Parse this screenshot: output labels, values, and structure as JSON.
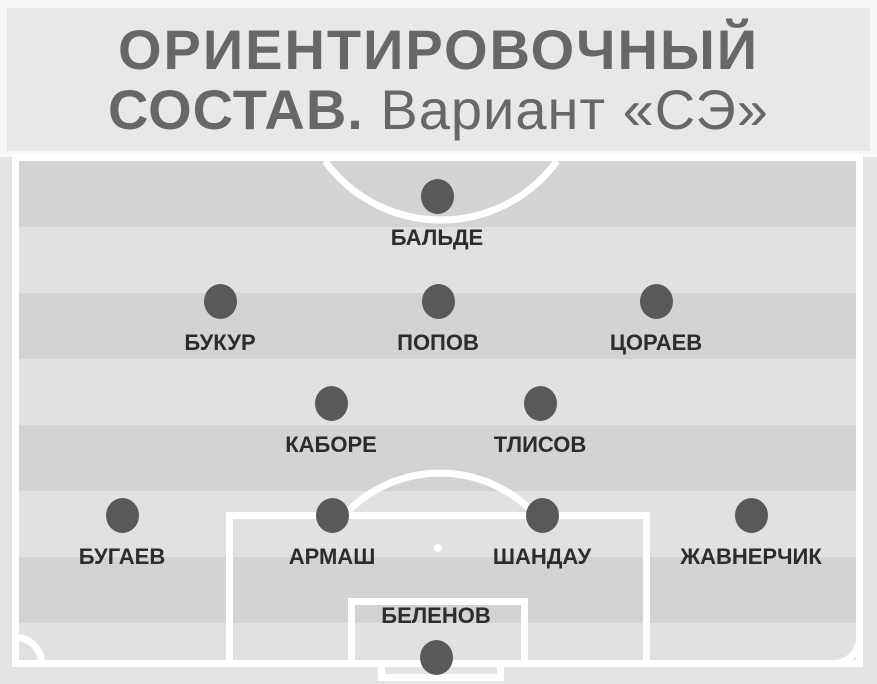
{
  "header": {
    "title_line1": "ОРИЕНТИРОВОЧНЫЙ",
    "title_line2_bold": "СОСТАВ.",
    "title_line2_regular": "Вариант «СЭ»"
  },
  "formation": {
    "shape": "4-2-3-1",
    "lines": [
      {
        "role": "forward",
        "players": [
          {
            "name": "БАЛЬДЕ"
          }
        ]
      },
      {
        "role": "attacking-midfield",
        "players": [
          {
            "name": "БУКУР"
          },
          {
            "name": "ПОПОВ"
          },
          {
            "name": "ЦОРАЕВ"
          }
        ]
      },
      {
        "role": "central-midfield",
        "players": [
          {
            "name": "КАБОРЕ"
          },
          {
            "name": "ТЛИСОВ"
          }
        ]
      },
      {
        "role": "defense",
        "players": [
          {
            "name": "БУГАЕВ"
          },
          {
            "name": "АРМАШ"
          },
          {
            "name": "ШАНДАУ"
          },
          {
            "name": "ЖАВНЕРЧИК"
          }
        ]
      },
      {
        "role": "goalkeeper",
        "players": [
          {
            "name": "БЕЛЕНОВ"
          }
        ]
      }
    ]
  },
  "colors": {
    "page_bg": "#f7f7f8",
    "header_bg": "#e8e8e9",
    "title_text": "#67676a",
    "lower_bg": "#e4e4e6",
    "stripe_dark": "#d2d3d5",
    "stripe_light": "#e0e1e3",
    "pitch_line": "#ffffff",
    "player_dot": "#58595b",
    "player_label": "#2c2c2e"
  }
}
